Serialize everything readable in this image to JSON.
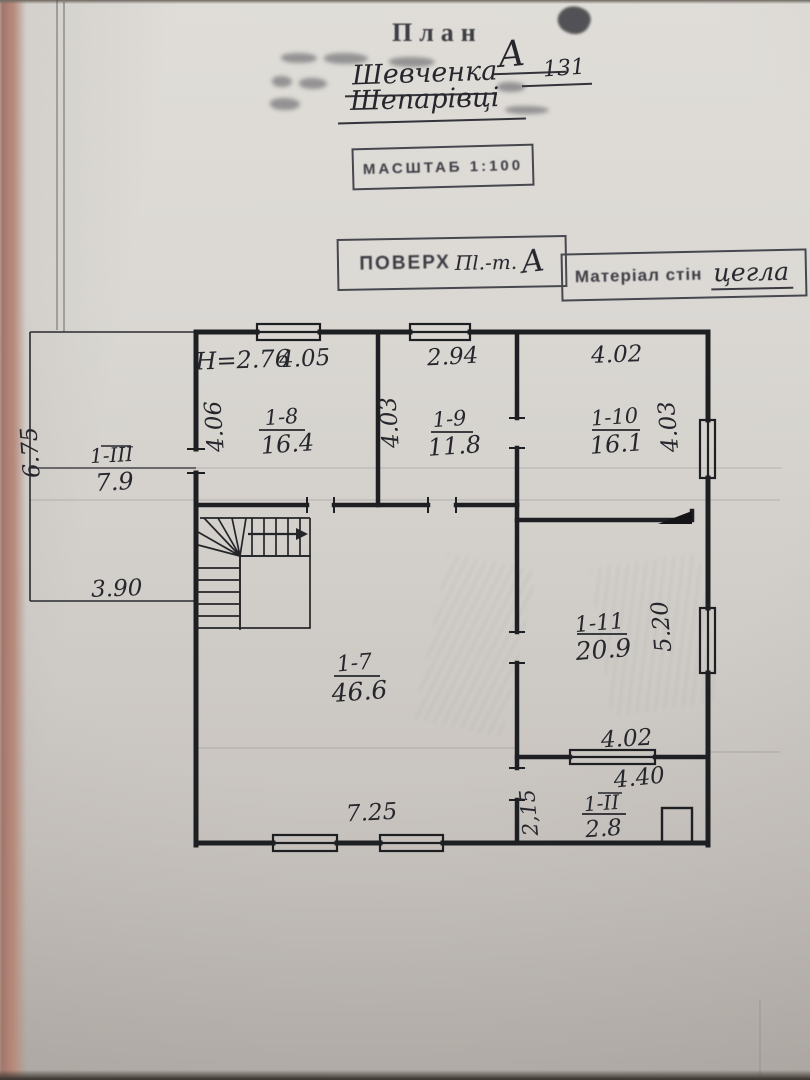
{
  "document": {
    "title": "План",
    "form": {
      "letter_value": "А",
      "street_value": "Шевченка",
      "number_value": "131",
      "settlement_value": "Шепарівці"
    },
    "scale_stamp": {
      "text": "МАСШТАБ 1:100"
    },
    "floor_stamp": {
      "label": "ПОВЕРХ",
      "insert": "Пl.-т.",
      "letter": "А"
    },
    "material_stamp": {
      "label": "Матеріал стін",
      "value": "цегла"
    }
  },
  "plan": {
    "ceiling_height": "Н=2.76",
    "rooms": [
      {
        "id": "1-8",
        "area": "16.4"
      },
      {
        "id": "1-9",
        "area": "11.8"
      },
      {
        "id": "1-10",
        "area": "16.1"
      },
      {
        "id": "1-7",
        "area": "46.6"
      },
      {
        "id": "1-11",
        "area": "20.9"
      },
      {
        "id": "1-ІІ",
        "area": "2.8"
      },
      {
        "id": "1-ІІІ",
        "area": "7.9"
      }
    ],
    "dims": {
      "r8_w": "4.05",
      "r8_d": "4.06",
      "r9_w": "2.94",
      "r9_d": "4.03",
      "r10_w": "4.02",
      "r10_d": "4.03",
      "r7_w": "7.25",
      "r11_w": "4.02",
      "r11_d": "5.20",
      "r2_w": "4.40",
      "r2_d": "2,15",
      "porch_d": "6.75",
      "porch_w": "3.90"
    }
  }
}
